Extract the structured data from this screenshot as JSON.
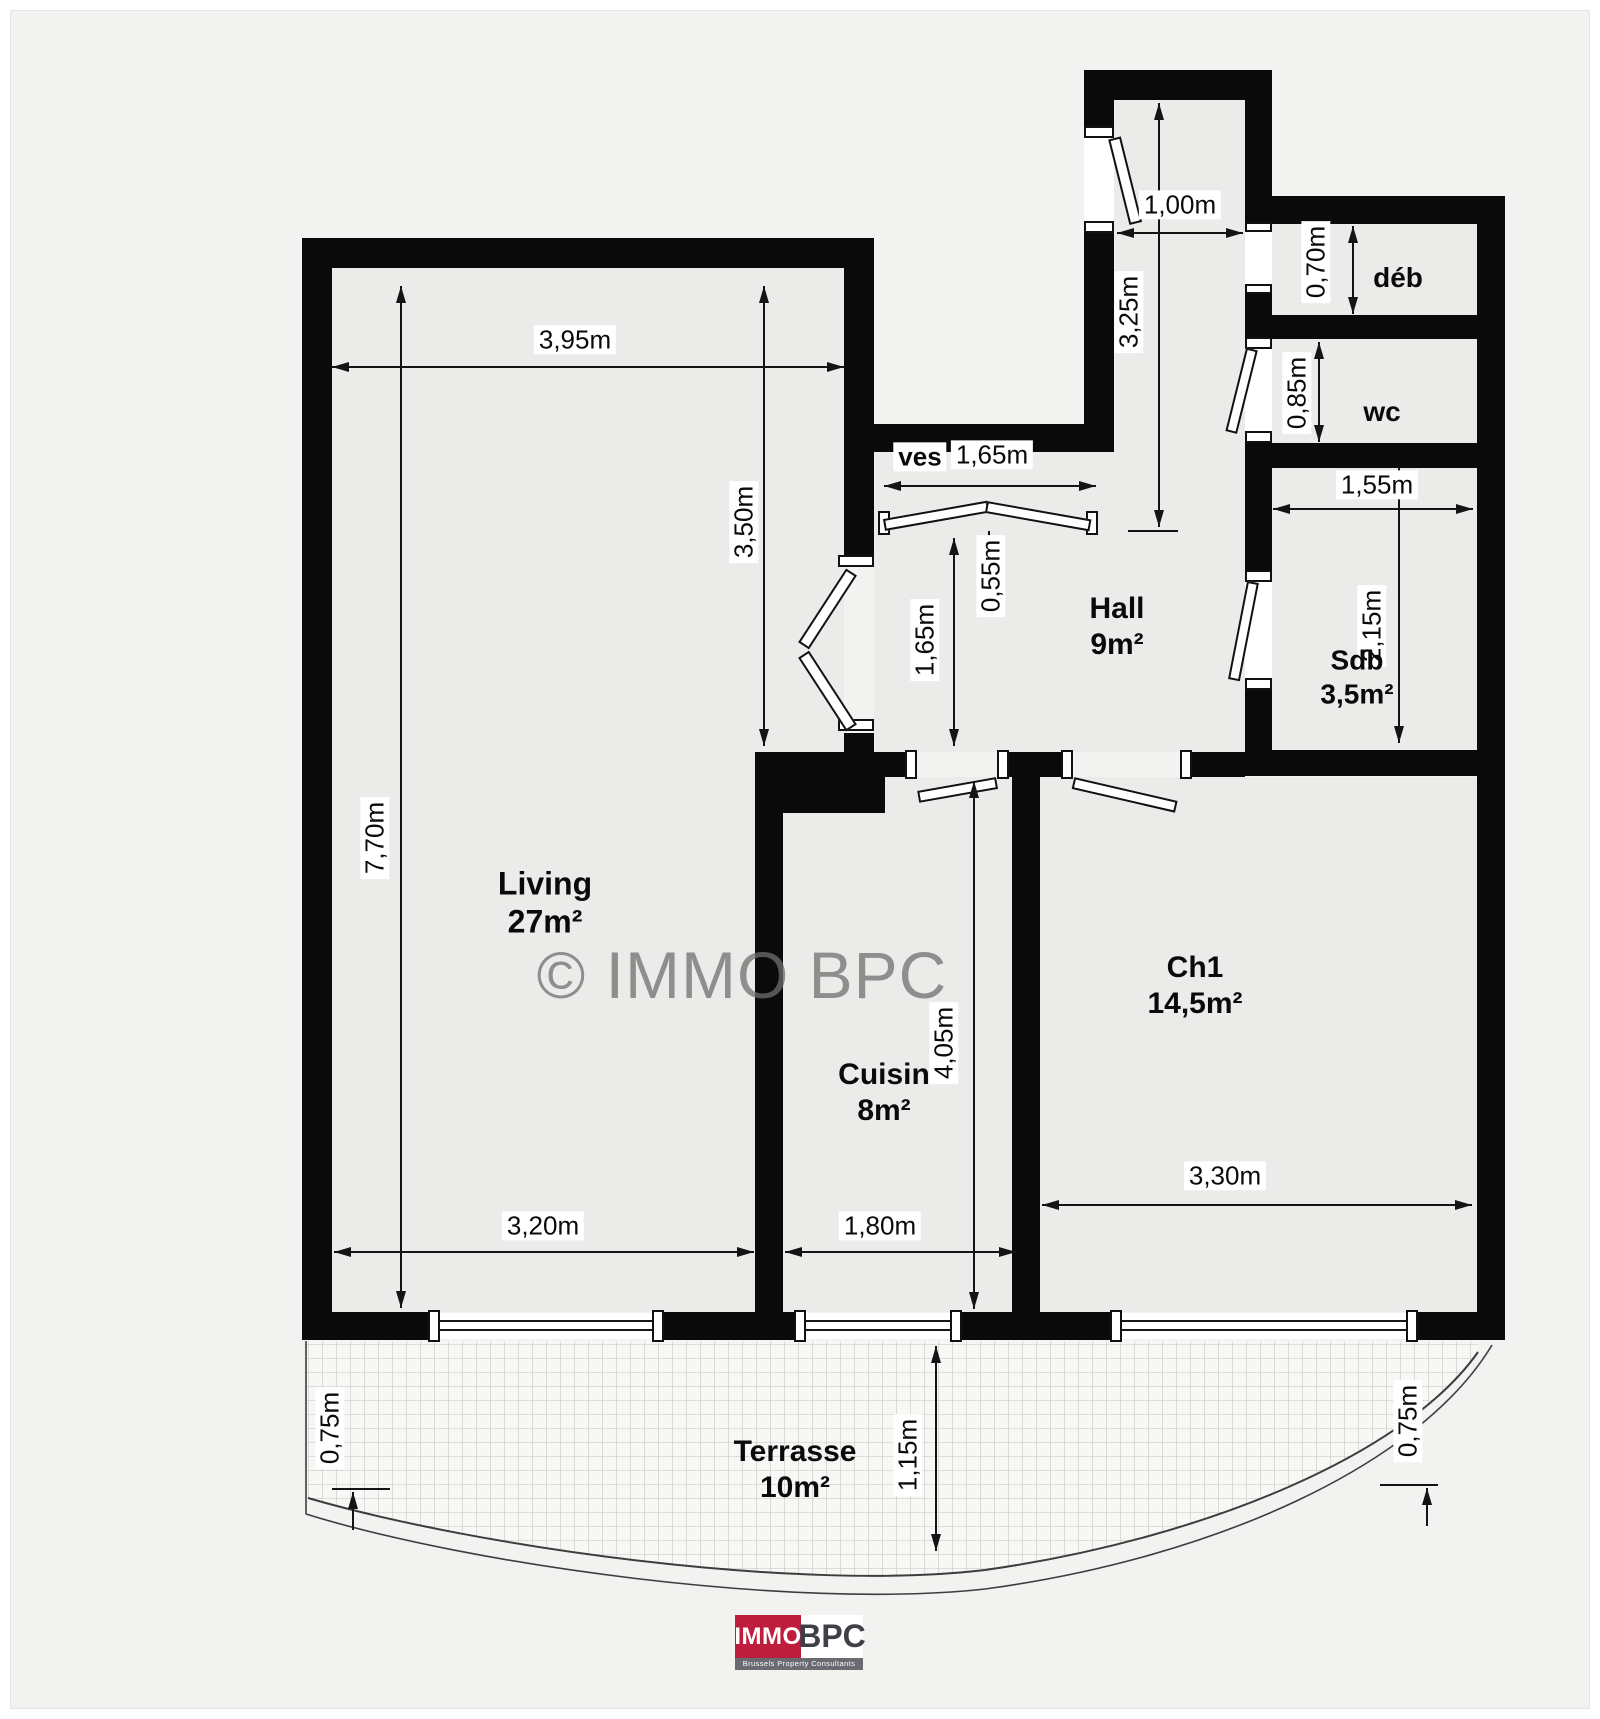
{
  "watermark": "© IMMO BPC",
  "rooms": {
    "living": {
      "name": "Living",
      "area": "27m²"
    },
    "cuisin": {
      "name": "Cuisin",
      "area": "8m²"
    },
    "ch1": {
      "name": "Ch1",
      "area": "14,5m²"
    },
    "hall": {
      "name": "Hall",
      "area": "9m²"
    },
    "sdb": {
      "name": "Sdb",
      "area": "3,5m²"
    },
    "wc": {
      "name": "wc"
    },
    "deb": {
      "name": "déb"
    },
    "ves": {
      "name": "ves"
    },
    "terrasse": {
      "name": "Terrasse",
      "area": "10m²"
    }
  },
  "dimensions": {
    "living_width": "3,95m",
    "living_height": "7,70m",
    "living_upper_h": "3,50m",
    "living_lower_w": "3,20m",
    "ves_width": "1,65m",
    "entry_width": "1,00m",
    "entry_length": "3,25m",
    "deb_depth": "0,70m",
    "wc_depth": "0,85m",
    "sdb_width": "1,55m",
    "sdb_depth": "2,15m",
    "hall_step": "0,55m",
    "hall_depth": "1,65m",
    "cuisin_height": "4,05m",
    "cuisin_width": "1,80m",
    "ch1_width": "3,30m",
    "terrasse_depth": "1,15m",
    "terrasse_left": "0,75m",
    "terrasse_right": "0,75m"
  },
  "logo": {
    "immo": "IMMO",
    "bpc": "BPC",
    "tagline": "Brussels Property Consultants"
  },
  "colors": {
    "wall": "#0a0a0a",
    "logo_red": "#be1e3c",
    "logo_gray": "#6a6a73"
  }
}
